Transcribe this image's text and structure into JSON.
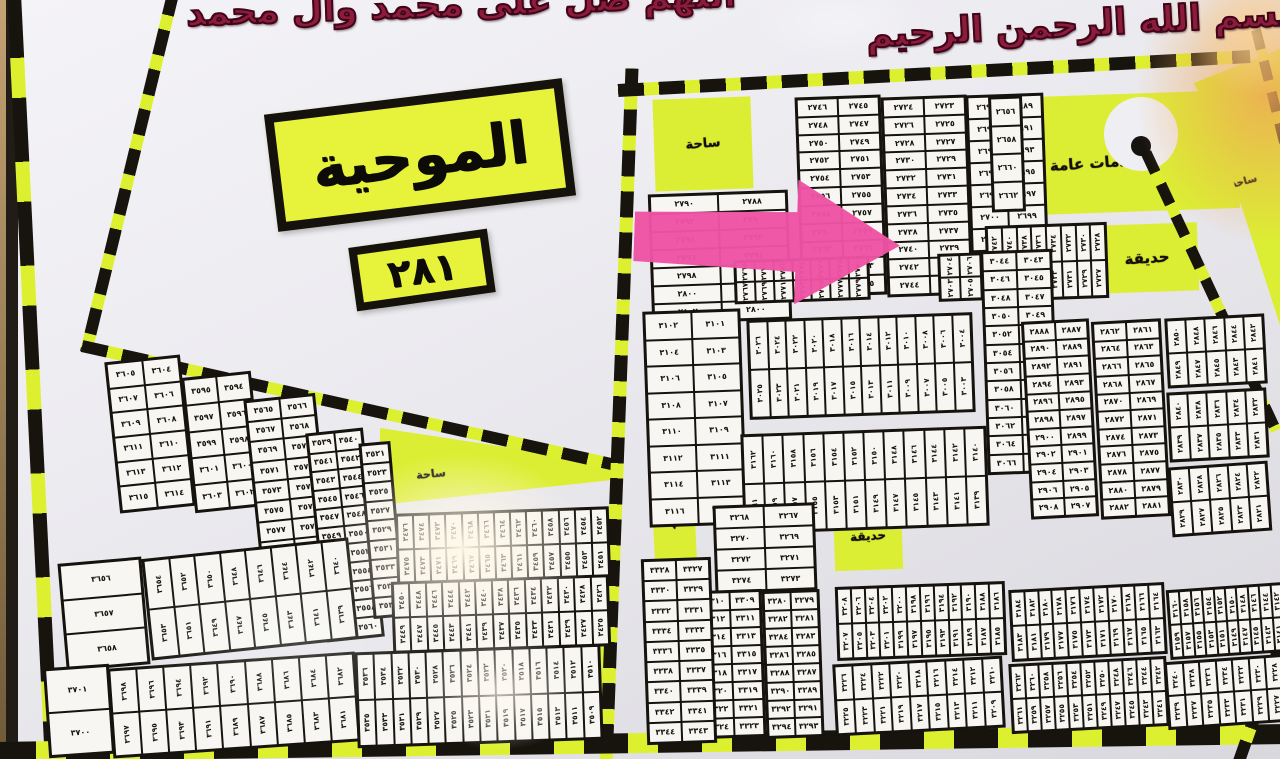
{
  "header": {
    "salawat": "اللهم صل على محمد وآل محمد",
    "basmala": "بسم الله الرحمن الرحيم"
  },
  "title": {
    "name": "الموحية",
    "number": "٢٨١"
  },
  "colors": {
    "road_dark": "#17140e",
    "road_yellow": "#ddf02f",
    "zone_yellow": "#dcee33",
    "board": "#efeef2",
    "block_line": "#16130e",
    "cell_bg": "#f7f6f2",
    "maroon_text": "#8c1c3c",
    "arrow_pink": "#ee53a3",
    "roundabout_dot": "#171310"
  },
  "roads": [
    {
      "x1": 14,
      "y1": -6,
      "x2": 52,
      "y2": 764,
      "w": 14,
      "a": 64,
      "b": 40
    },
    {
      "x1": 174,
      "y1": -10,
      "x2": 86,
      "y2": 352,
      "w": 12,
      "a": 26,
      "b": 15
    },
    {
      "x1": 82,
      "y1": 346,
      "x2": 620,
      "y2": 466,
      "w": 12,
      "a": 26,
      "b": 15
    },
    {
      "x1": 632,
      "y1": 68,
      "x2": 606,
      "y2": 764,
      "w": 13,
      "a": 26,
      "b": 15
    },
    {
      "x1": 618,
      "y1": 90,
      "x2": 1250,
      "y2": 56,
      "w": 13,
      "a": 26,
      "b": 15
    },
    {
      "x1": 1146,
      "y1": 152,
      "x2": 1276,
      "y2": 430,
      "w": 11,
      "a": 22,
      "b": 13
    },
    {
      "x1": 1256,
      "y1": 30,
      "x2": 1286,
      "y2": 150,
      "w": 10,
      "a": 20,
      "b": 12
    },
    {
      "x1": -8,
      "y1": 752,
      "x2": 1290,
      "y2": 734,
      "w": 20,
      "a": 44,
      "b": 30
    },
    {
      "x1": 1238,
      "y1": 764,
      "x2": 1288,
      "y2": 622,
      "w": 12,
      "a": 24,
      "b": 14
    }
  ],
  "areas": [
    {
      "id": "plaza-top",
      "label": "ساحة",
      "x": 654,
      "y": 98,
      "w": 98,
      "h": 92,
      "rot": -2,
      "fs": 13,
      "lrot": -3,
      "lx": 50,
      "ly": 50
    },
    {
      "id": "public-services",
      "label": "خدمات عامة",
      "x": 1006,
      "y": 94,
      "w": 232,
      "h": 118,
      "rot": -2,
      "fs": 15,
      "lrot": -2,
      "lx": 38,
      "ly": 58
    },
    {
      "id": "services-fill",
      "label": "",
      "x": 1160,
      "y": 94,
      "w": 50,
      "h": 94,
      "rot": -2,
      "fs": 0,
      "lrot": 0,
      "lx": 50,
      "ly": 50
    },
    {
      "id": "garden-north",
      "label": "حديقة",
      "x": 1096,
      "y": 224,
      "w": 102,
      "h": 68,
      "rot": -2,
      "fs": 15,
      "lrot": -2,
      "lx": 50,
      "ly": 50
    },
    {
      "id": "plaza-right",
      "label": "ساحة",
      "x": 1186,
      "y": 48,
      "w": 96,
      "h": 292,
      "rot": 0,
      "fs": 10,
      "lrot": -15,
      "lx": 60,
      "ly": 46,
      "clip": "polygon(8% 12%, 100% 0%, 100% 97%, 30% 26%)"
    },
    {
      "id": "plaza-mid",
      "label": "ساحة",
      "x": 380,
      "y": 408,
      "w": 232,
      "h": 100,
      "rot": 0,
      "fs": 11,
      "lrot": -6,
      "lx": 22,
      "ly": 66,
      "clip": "polygon(0% 20%, 100% 55%, 100% 72%, 0% 97%)"
    },
    {
      "id": "services-strip",
      "label": "خدمات عامة",
      "x": 652,
      "y": 442,
      "w": 42,
      "h": 122,
      "rot": -3,
      "fs": 9,
      "lrot": 90,
      "lx": 50,
      "ly": 50
    },
    {
      "id": "green-strip",
      "label": "",
      "x": 588,
      "y": 556,
      "w": 24,
      "h": 182,
      "rot": -1,
      "fs": 0,
      "lrot": 0,
      "lx": 50,
      "ly": 50
    },
    {
      "id": "garden-mid",
      "label": "حديقة",
      "x": 834,
      "y": 502,
      "w": 68,
      "h": 68,
      "rot": -2,
      "fs": 12,
      "lrot": -2,
      "lx": 50,
      "ly": 50
    }
  ],
  "roundabout": {
    "cx": 1141,
    "cy": 134,
    "r": 37,
    "dot_cx": 1141,
    "dot_cy": 146,
    "dot_r": 10
  },
  "arrow": {
    "x": 634,
    "y": 176,
    "w": 266,
    "h": 130,
    "rot": 2
  },
  "blocks": [
    {
      "id": "RB1",
      "x": 650,
      "y": 192,
      "w": 134,
      "h": 124,
      "rot": -2,
      "kind": "g",
      "cols": [
        [
          2790,
          2802,
          2
        ],
        [
          2788,
          2800,
          2
        ]
      ]
    },
    {
      "id": "RB2",
      "x": 798,
      "y": 96,
      "w": 80,
      "h": 194,
      "rot": -2,
      "kind": "g",
      "cols": [
        [
          2746,
          2766,
          2
        ],
        [
          2745,
          2765,
          2
        ]
      ]
    },
    {
      "id": "RB3",
      "x": 884,
      "y": 96,
      "w": 80,
      "h": 194,
      "rot": -2,
      "kind": "g",
      "cols": [
        [
          2724,
          2744,
          2
        ],
        [
          2723,
          2743,
          2
        ]
      ]
    },
    {
      "id": "RB4",
      "x": 734,
      "y": 258,
      "w": 130,
      "h": 38,
      "rot": -2,
      "kind": "s",
      "rows": [
        [
          2768,
          2780,
          2
        ],
        [
          2767,
          2779,
          2
        ]
      ]
    },
    {
      "id": "RB5",
      "x": 968,
      "y": 94,
      "w": 72,
      "h": 152,
      "rot": -2,
      "kind": "g",
      "cols": [
        [
          2690,
          2702,
          2
        ],
        [
          2689,
          2701,
          2
        ]
      ]
    },
    {
      "id": "RB6",
      "x": 938,
      "y": 252,
      "w": 100,
      "h": 42,
      "rot": -2,
      "kind": "s",
      "rows": [
        [
          2704,
          2712,
          2
        ],
        [
          2703,
          2711,
          2
        ]
      ]
    },
    {
      "id": "RB7",
      "x": 990,
      "y": 96,
      "w": 28,
      "h": 110,
      "rot": -2,
      "kind": "g",
      "cols": [
        [
          2656,
          2662,
          2
        ]
      ]
    },
    {
      "id": "RB8",
      "x": 986,
      "y": 224,
      "w": 116,
      "h": 70,
      "rot": -2,
      "kind": "s",
      "rows": [
        [
          2742,
          2728,
          -2
        ],
        [
          2741,
          2727,
          -2
        ]
      ]
    },
    {
      "id": "RM1",
      "x": 646,
      "y": 310,
      "w": 92,
      "h": 210,
      "rot": -2,
      "kind": "g",
      "cols": [
        [
          3102,
          3116,
          2
        ],
        [
          3101,
          3115,
          2
        ]
      ]
    },
    {
      "id": "RM2",
      "x": 748,
      "y": 316,
      "w": 220,
      "h": 94,
      "rot": -2,
      "kind": "s",
      "rows": [
        [
          3026,
          3004,
          -2
        ],
        [
          3025,
          3003,
          -2
        ]
      ]
    },
    {
      "id": "RM3",
      "x": 742,
      "y": 430,
      "w": 240,
      "h": 94,
      "rot": -2,
      "kind": "s",
      "rows": [
        [
          3162,
          3140,
          -2
        ],
        [
          3161,
          3139,
          -2
        ]
      ]
    },
    {
      "id": "RM4",
      "x": 984,
      "y": 250,
      "w": 66,
      "h": 218,
      "rot": -2,
      "kind": "g",
      "cols": [
        [
          3044,
          3066,
          2
        ],
        [
          3043,
          3065,
          2
        ]
      ]
    },
    {
      "id": "RM5",
      "x": 1026,
      "y": 320,
      "w": 62,
      "h": 192,
      "rot": -3,
      "kind": "g",
      "cols": [
        [
          2888,
          2908,
          2
        ],
        [
          2887,
          2907,
          2
        ]
      ]
    },
    {
      "id": "RM6",
      "x": 1096,
      "y": 320,
      "w": 64,
      "h": 192,
      "rot": -3,
      "kind": "g",
      "cols": [
        [
          2862,
          2882,
          2
        ],
        [
          2861,
          2881,
          2
        ]
      ]
    },
    {
      "id": "RM7",
      "x": 1166,
      "y": 316,
      "w": 94,
      "h": 64,
      "rot": -3,
      "kind": "s",
      "rows": [
        [
          2850,
          2842,
          -2
        ],
        [
          2849,
          2841,
          -2
        ]
      ]
    },
    {
      "id": "RM8",
      "x": 1168,
      "y": 390,
      "w": 94,
      "h": 64,
      "rot": -3,
      "kind": "s",
      "rows": [
        [
          2840,
          2832,
          -2
        ],
        [
          2839,
          2831,
          -2
        ]
      ]
    },
    {
      "id": "RM9",
      "x": 1170,
      "y": 464,
      "w": 94,
      "h": 64,
      "rot": -4,
      "kind": "s",
      "rows": [
        [
          2830,
          2822,
          -2
        ],
        [
          2829,
          2821,
          -2
        ]
      ]
    },
    {
      "id": "RL1",
      "x": 714,
      "y": 504,
      "w": 96,
      "h": 82,
      "rot": -2,
      "kind": "g",
      "cols": [
        [
          3268,
          3274,
          2
        ],
        [
          3267,
          3273,
          2
        ]
      ]
    },
    {
      "id": "RL2",
      "x": 700,
      "y": 590,
      "w": 58,
      "h": 142,
      "rot": -2,
      "kind": "g",
      "cols": [
        [
          3310,
          3324,
          2
        ],
        [
          3309,
          3323,
          2
        ]
      ]
    },
    {
      "id": "RL3",
      "x": 764,
      "y": 590,
      "w": 52,
      "h": 142,
      "rot": -2,
      "kind": "g",
      "cols": [
        [
          3280,
          3294,
          2
        ],
        [
          3279,
          3293,
          2
        ]
      ]
    },
    {
      "id": "RL4",
      "x": 644,
      "y": 558,
      "w": 64,
      "h": 180,
      "rot": -2,
      "kind": "g",
      "cols": [
        [
          3328,
          3344,
          2
        ],
        [
          3327,
          3343,
          2
        ]
      ]
    },
    {
      "id": "RL5",
      "x": 836,
      "y": 584,
      "w": 164,
      "h": 68,
      "rot": -2,
      "kind": "s",
      "rows": [
        [
          3208,
          3186,
          -2
        ],
        [
          3207,
          3185,
          -2
        ]
      ]
    },
    {
      "id": "RL6",
      "x": 834,
      "y": 660,
      "w": 164,
      "h": 66,
      "rot": -3,
      "kind": "s",
      "rows": [
        [
          3226,
          3210,
          -2
        ],
        [
          3225,
          3209,
          -2
        ]
      ]
    },
    {
      "id": "RL7",
      "x": 1010,
      "y": 586,
      "w": 150,
      "h": 66,
      "rot": -3,
      "kind": "s",
      "rows": [
        [
          3184,
          3164,
          -2
        ],
        [
          3183,
          3163,
          -2
        ]
      ]
    },
    {
      "id": "RL8",
      "x": 1168,
      "y": 586,
      "w": 112,
      "h": 64,
      "rot": -4,
      "kind": "s",
      "rows": [
        [
          3160,
          3142,
          -2
        ],
        [
          3159,
          3141,
          -2
        ]
      ]
    },
    {
      "id": "RL9",
      "x": 1010,
      "y": 660,
      "w": 152,
      "h": 64,
      "rot": -3,
      "kind": "s",
      "rows": [
        [
          3262,
          3242,
          -2
        ],
        [
          3261,
          3241,
          -2
        ]
      ]
    },
    {
      "id": "RL10",
      "x": 1166,
      "y": 658,
      "w": 114,
      "h": 62,
      "rot": -4,
      "kind": "s",
      "rows": [
        [
          3240,
          3228,
          -2
        ],
        [
          3239,
          3227,
          -2
        ]
      ]
    },
    {
      "id": "LT1",
      "x": 112,
      "y": 358,
      "w": 70,
      "h": 146,
      "rot": -6,
      "kind": "g",
      "cols": [
        [
          3605,
          3615,
          2
        ],
        [
          3604,
          3614,
          2
        ]
      ]
    },
    {
      "id": "LT2",
      "x": 188,
      "y": 374,
      "w": 64,
      "h": 130,
      "rot": -6,
      "kind": "g",
      "cols": [
        [
          3595,
          3603,
          2
        ],
        [
          3594,
          3602,
          2
        ]
      ]
    },
    {
      "id": "LT3",
      "x": 256,
      "y": 396,
      "w": 66,
      "h": 240,
      "rot": -6,
      "kind": "g",
      "cols": [
        [
          3565,
          3587,
          2
        ],
        [
          3566,
          3588,
          2
        ]
      ]
    },
    {
      "id": "LT4",
      "x": 316,
      "y": 430,
      "w": 52,
      "h": 204,
      "rot": -6,
      "kind": "g",
      "cols": [
        [
          3539,
          3559,
          2
        ],
        [
          3540,
          3560,
          2
        ]
      ]
    },
    {
      "id": "LT5",
      "x": 366,
      "y": 442,
      "w": 26,
      "h": 170,
      "rot": -5,
      "kind": "g",
      "cols": [
        [
          3521,
          3537,
          2
        ]
      ]
    },
    {
      "id": "LB1",
      "x": 62,
      "y": 560,
      "w": 78,
      "h": 102,
      "rot": -5,
      "kind": "g",
      "cols": [
        [
          3656,
          3658,
          1
        ]
      ]
    },
    {
      "id": "LB2",
      "x": 146,
      "y": 548,
      "w": 202,
      "h": 96,
      "rot": -6,
      "kind": "s",
      "rows": [
        [
          3654,
          3640,
          -2
        ],
        [
          3653,
          3639,
          -2
        ]
      ]
    },
    {
      "id": "LB3a",
      "x": 46,
      "y": 666,
      "w": 60,
      "h": 84,
      "rot": -4,
      "kind": "g",
      "cols": [
        [
          3701,
          3700,
          -1
        ]
      ]
    },
    {
      "id": "LB3b",
      "x": 110,
      "y": 660,
      "w": 242,
      "h": 84,
      "rot": -4,
      "kind": "s",
      "rows": [
        [
          3698,
          3682,
          -2
        ],
        [
          3697,
          3681,
          -2
        ]
      ]
    },
    {
      "id": "LB4",
      "x": 356,
      "y": 648,
      "w": 240,
      "h": 90,
      "rot": -2,
      "kind": "s",
      "rows": [
        [
          3536,
          3510,
          -2
        ],
        [
          3535,
          3509,
          -2
        ]
      ]
    },
    {
      "id": "M2",
      "x": 396,
      "y": 510,
      "w": 208,
      "h": 66,
      "rot": -2,
      "kind": "s",
      "rows": [
        [
          3476,
          3452,
          -2
        ],
        [
          3475,
          3451,
          -2
        ]
      ]
    },
    {
      "id": "M3",
      "x": 392,
      "y": 578,
      "w": 212,
      "h": 66,
      "rot": -2,
      "kind": "s",
      "rows": [
        [
          3450,
          3426,
          -2
        ],
        [
          3449,
          3425,
          -2
        ]
      ]
    }
  ],
  "glares": [
    {
      "x": 462,
      "y": 548,
      "rx": 130,
      "ry": 95,
      "c": "255,248,232",
      "a": 0.97
    },
    {
      "x": 500,
      "y": 690,
      "rx": 85,
      "ry": 60,
      "c": "255,250,240",
      "a": 0.75
    },
    {
      "x": 300,
      "y": 640,
      "rx": 180,
      "ry": 90,
      "c": "255,255,255",
      "a": 0.22
    },
    {
      "x": 840,
      "y": 22,
      "rx": 90,
      "ry": 40,
      "c": "255,255,255",
      "a": 0.3
    },
    {
      "x": 1266,
      "y": 95,
      "rx": 130,
      "ry": 150,
      "c": "238,168,88",
      "a": 0.85
    },
    {
      "x": 1252,
      "y": 36,
      "rx": 60,
      "ry": 60,
      "c": "250,212,150",
      "a": 0.7
    }
  ]
}
